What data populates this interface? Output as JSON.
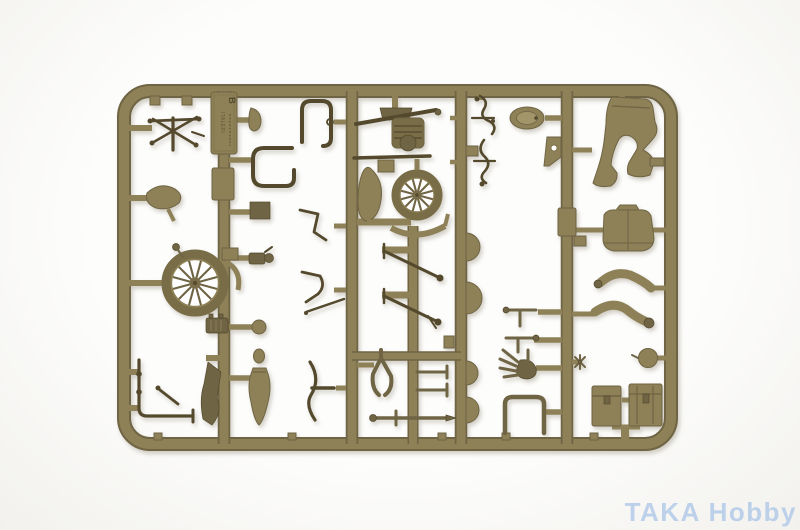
{
  "colors": {
    "background": "#fdfdfc",
    "background_edge": "#f2f1ed",
    "plastic": "#8e8157",
    "plastic_hi": "#a3956a",
    "plastic_mid": "#6f6444",
    "plastic_dark": "#54492d",
    "tire": "#786d47",
    "spoke_bg": "#fefefe",
    "emboss": "#564d31",
    "watermark": "#b7cdea"
  },
  "sprue": {
    "runner_letter": "B",
    "embossed_brand": "ITALERI"
  },
  "watermark": {
    "text": "TAKA Hobby"
  },
  "parts_inventory": [
    "handlebars",
    "saddle seat",
    "front spoked wheel",
    "rear spoked wheel",
    "front mudflap",
    "rear mudguard",
    "fuel tank half",
    "engine block",
    "exhaust pipe",
    "curved exhaust",
    "headlight",
    "headlight bracket",
    "amphora-shaped tank",
    "fork blade",
    "luggage rack",
    "hand levers",
    "foot peg rods",
    "wishbone bracket",
    "linkage rods",
    "gloved hand",
    "rider legs",
    "rider torso",
    "rider arms",
    "rider head",
    "pannier box 1",
    "pannier box 2",
    "mudguard half discs",
    "small brackets"
  ]
}
